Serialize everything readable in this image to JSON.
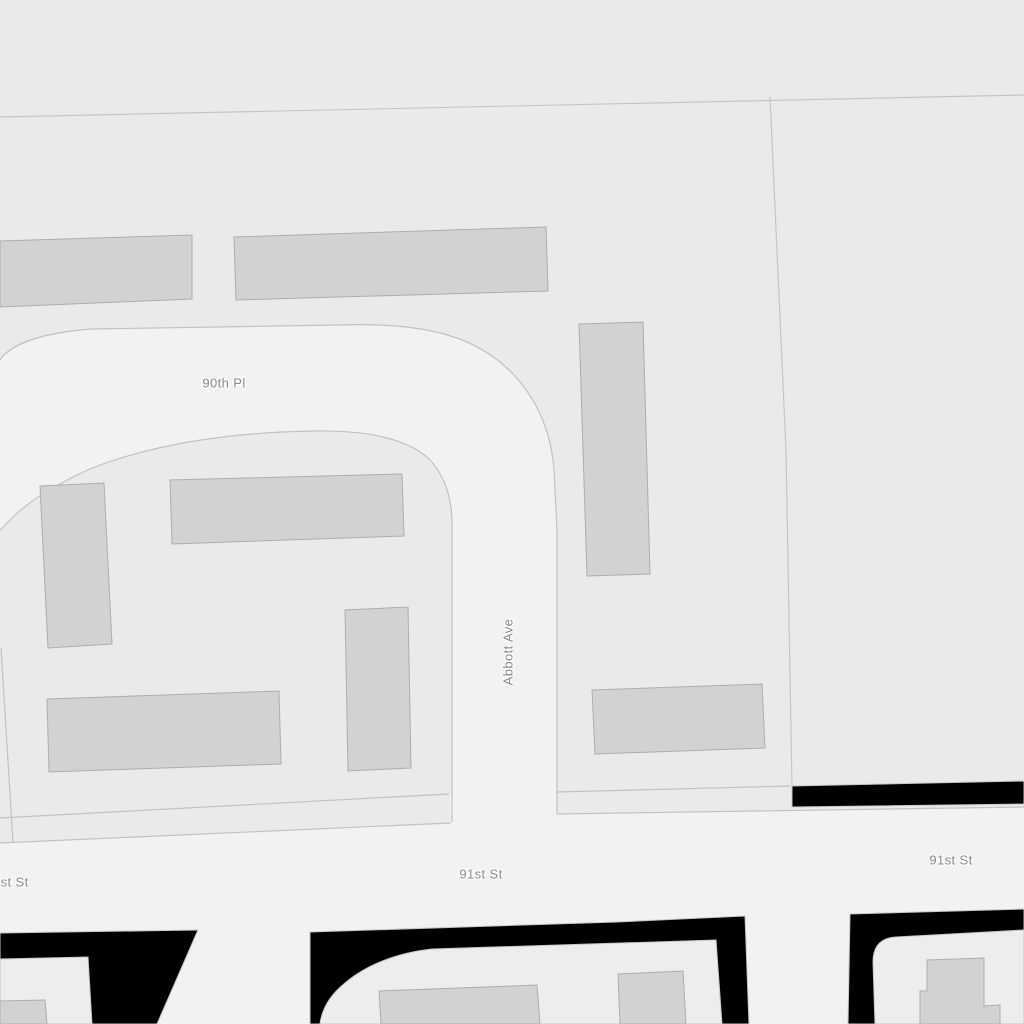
{
  "map": {
    "street_labels": [
      {
        "id": "90th-pl",
        "text": "90th Pl"
      },
      {
        "id": "abbott-ave",
        "text": "Abbott Ave"
      },
      {
        "id": "91st-st-left",
        "text": "91st St"
      },
      {
        "id": "91st-st-center",
        "text": "91st St"
      },
      {
        "id": "91st-st-right",
        "text": "91st St"
      }
    ],
    "colors": {
      "background": "#eaeaea",
      "road_fill": "#f2f2f2",
      "road_casing": "#c2c2c2",
      "parcel_line": "#c6c6c6",
      "building_fill": "#d2d2d2",
      "building_stroke": "#adadad",
      "court_fill": "#ededed",
      "no_data_fill": "#000000",
      "label_text": "#8a8a8a"
    }
  }
}
